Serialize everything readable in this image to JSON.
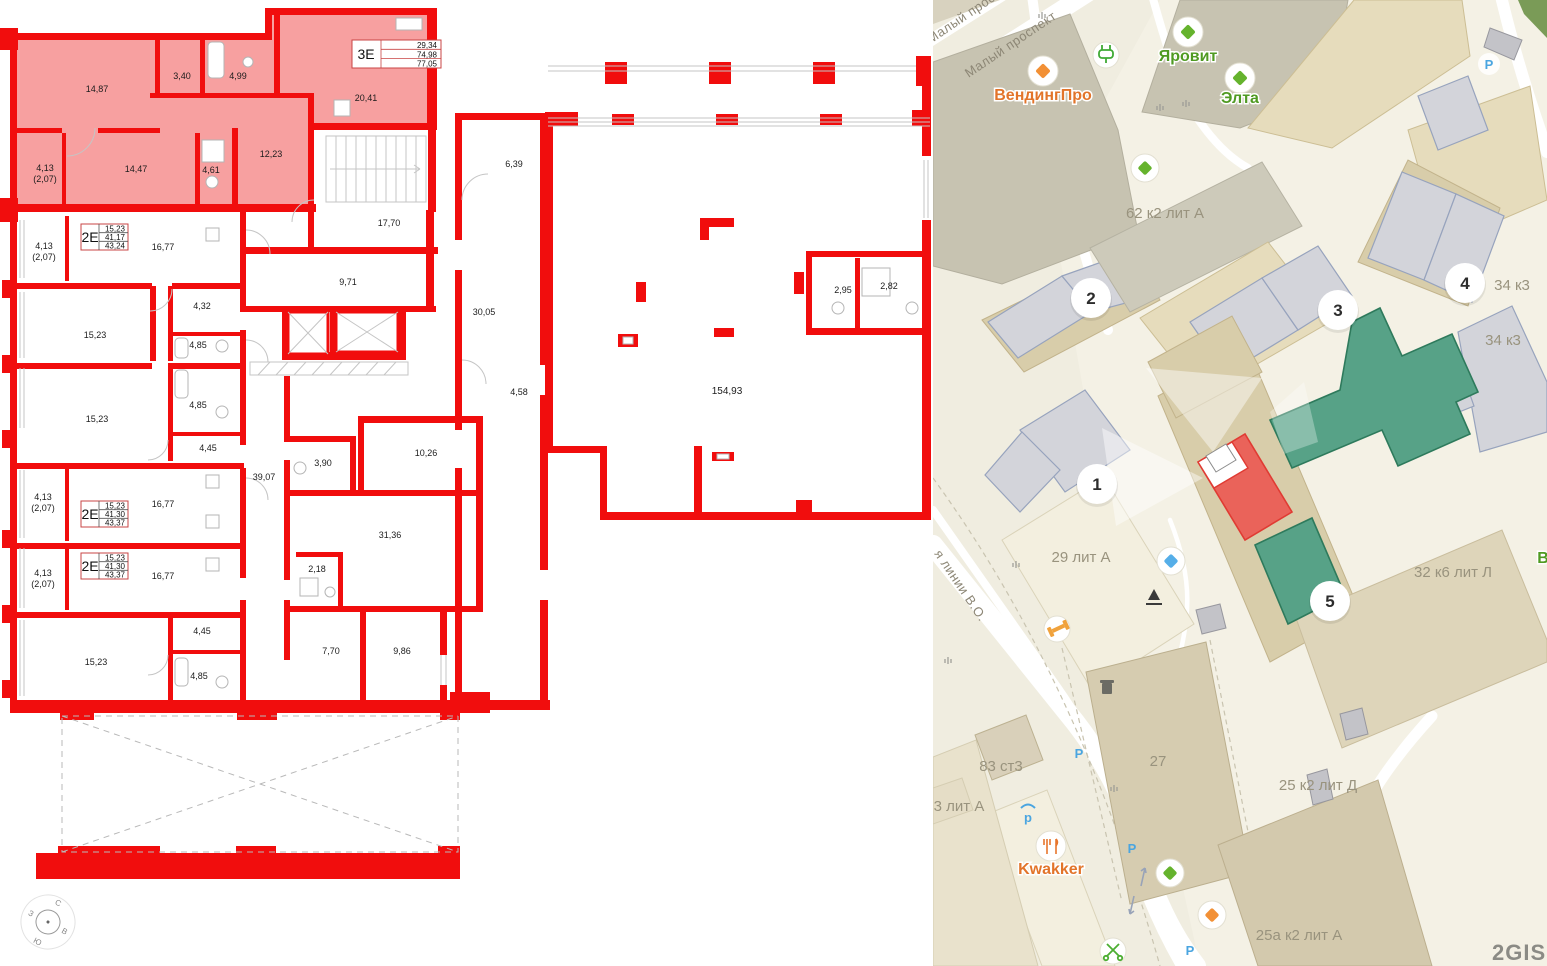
{
  "plan": {
    "unit_boxes": [
      {
        "code": "3Е",
        "rows": [
          "29,34",
          "74,98",
          "77,05"
        ]
      },
      {
        "code": "2Е",
        "rows": [
          "15,23",
          "41,17",
          "43,24"
        ]
      },
      {
        "code": "2Е",
        "rows": [
          "15,23",
          "41,30",
          "43,37"
        ]
      },
      {
        "code": "2Е",
        "rows": [
          "15,23",
          "41,30",
          "43,37"
        ]
      }
    ],
    "labels": [
      "14,87",
      "3,40",
      "4,99",
      "20,41",
      "4,13",
      "(2,07)",
      "14,47",
      "4,61",
      "12,23",
      "17,70",
      "16,77",
      "4,13",
      "(2,07)",
      "4,32",
      "15,23",
      "4,85",
      "9,71",
      "30,05",
      "6,39",
      "15,23",
      "4,85",
      "4,45",
      "39,07",
      "4,13",
      "(2,07)",
      "16,77",
      "4,13",
      "(2,07)",
      "16,77",
      "3,90",
      "10,26",
      "4,58",
      "31,36",
      "2,18",
      "4,45",
      "15,23",
      "4,85",
      "7,70",
      "9,86",
      "154,93",
      "2,95",
      "2,82"
    ],
    "compass": {
      "n": "С",
      "e": "В",
      "s": "Ю",
      "w": "З"
    }
  },
  "map": {
    "markers": [
      "1",
      "2",
      "3",
      "4",
      "5"
    ],
    "street_labels": [
      "Малый проспект",
      "Малый проспект",
      "я линии В.О."
    ],
    "building_labels": [
      "62 к2 лит А",
      "34 к3",
      "34 к3",
      "29 лит А",
      "32 к6 лит Л",
      "27",
      "83 ст3",
      "3 лит А",
      "25 к2 лит Д",
      "25а к2 лит А"
    ],
    "poi_labels": [
      "ВендингПро",
      "Яровит",
      "Элта",
      "Kwakker",
      "В"
    ],
    "parking_letter": "Р",
    "covered_parking_letter": "p",
    "logo": "2GIS",
    "colors": {
      "land": "#f0ede0",
      "green_building": "#57a287",
      "red_building": "#ea635a",
      "gray_building": "#d3d4da",
      "tan_building": "#e6dcbc",
      "poi_orange": "#e2742a",
      "poi_green": "#4f9a22",
      "poi_blue": "#55aee8",
      "road": "#ffffff",
      "label_gray": "#99937e",
      "plan_red": "#f10d0d",
      "plan_pink": "#f7a0a0"
    }
  }
}
